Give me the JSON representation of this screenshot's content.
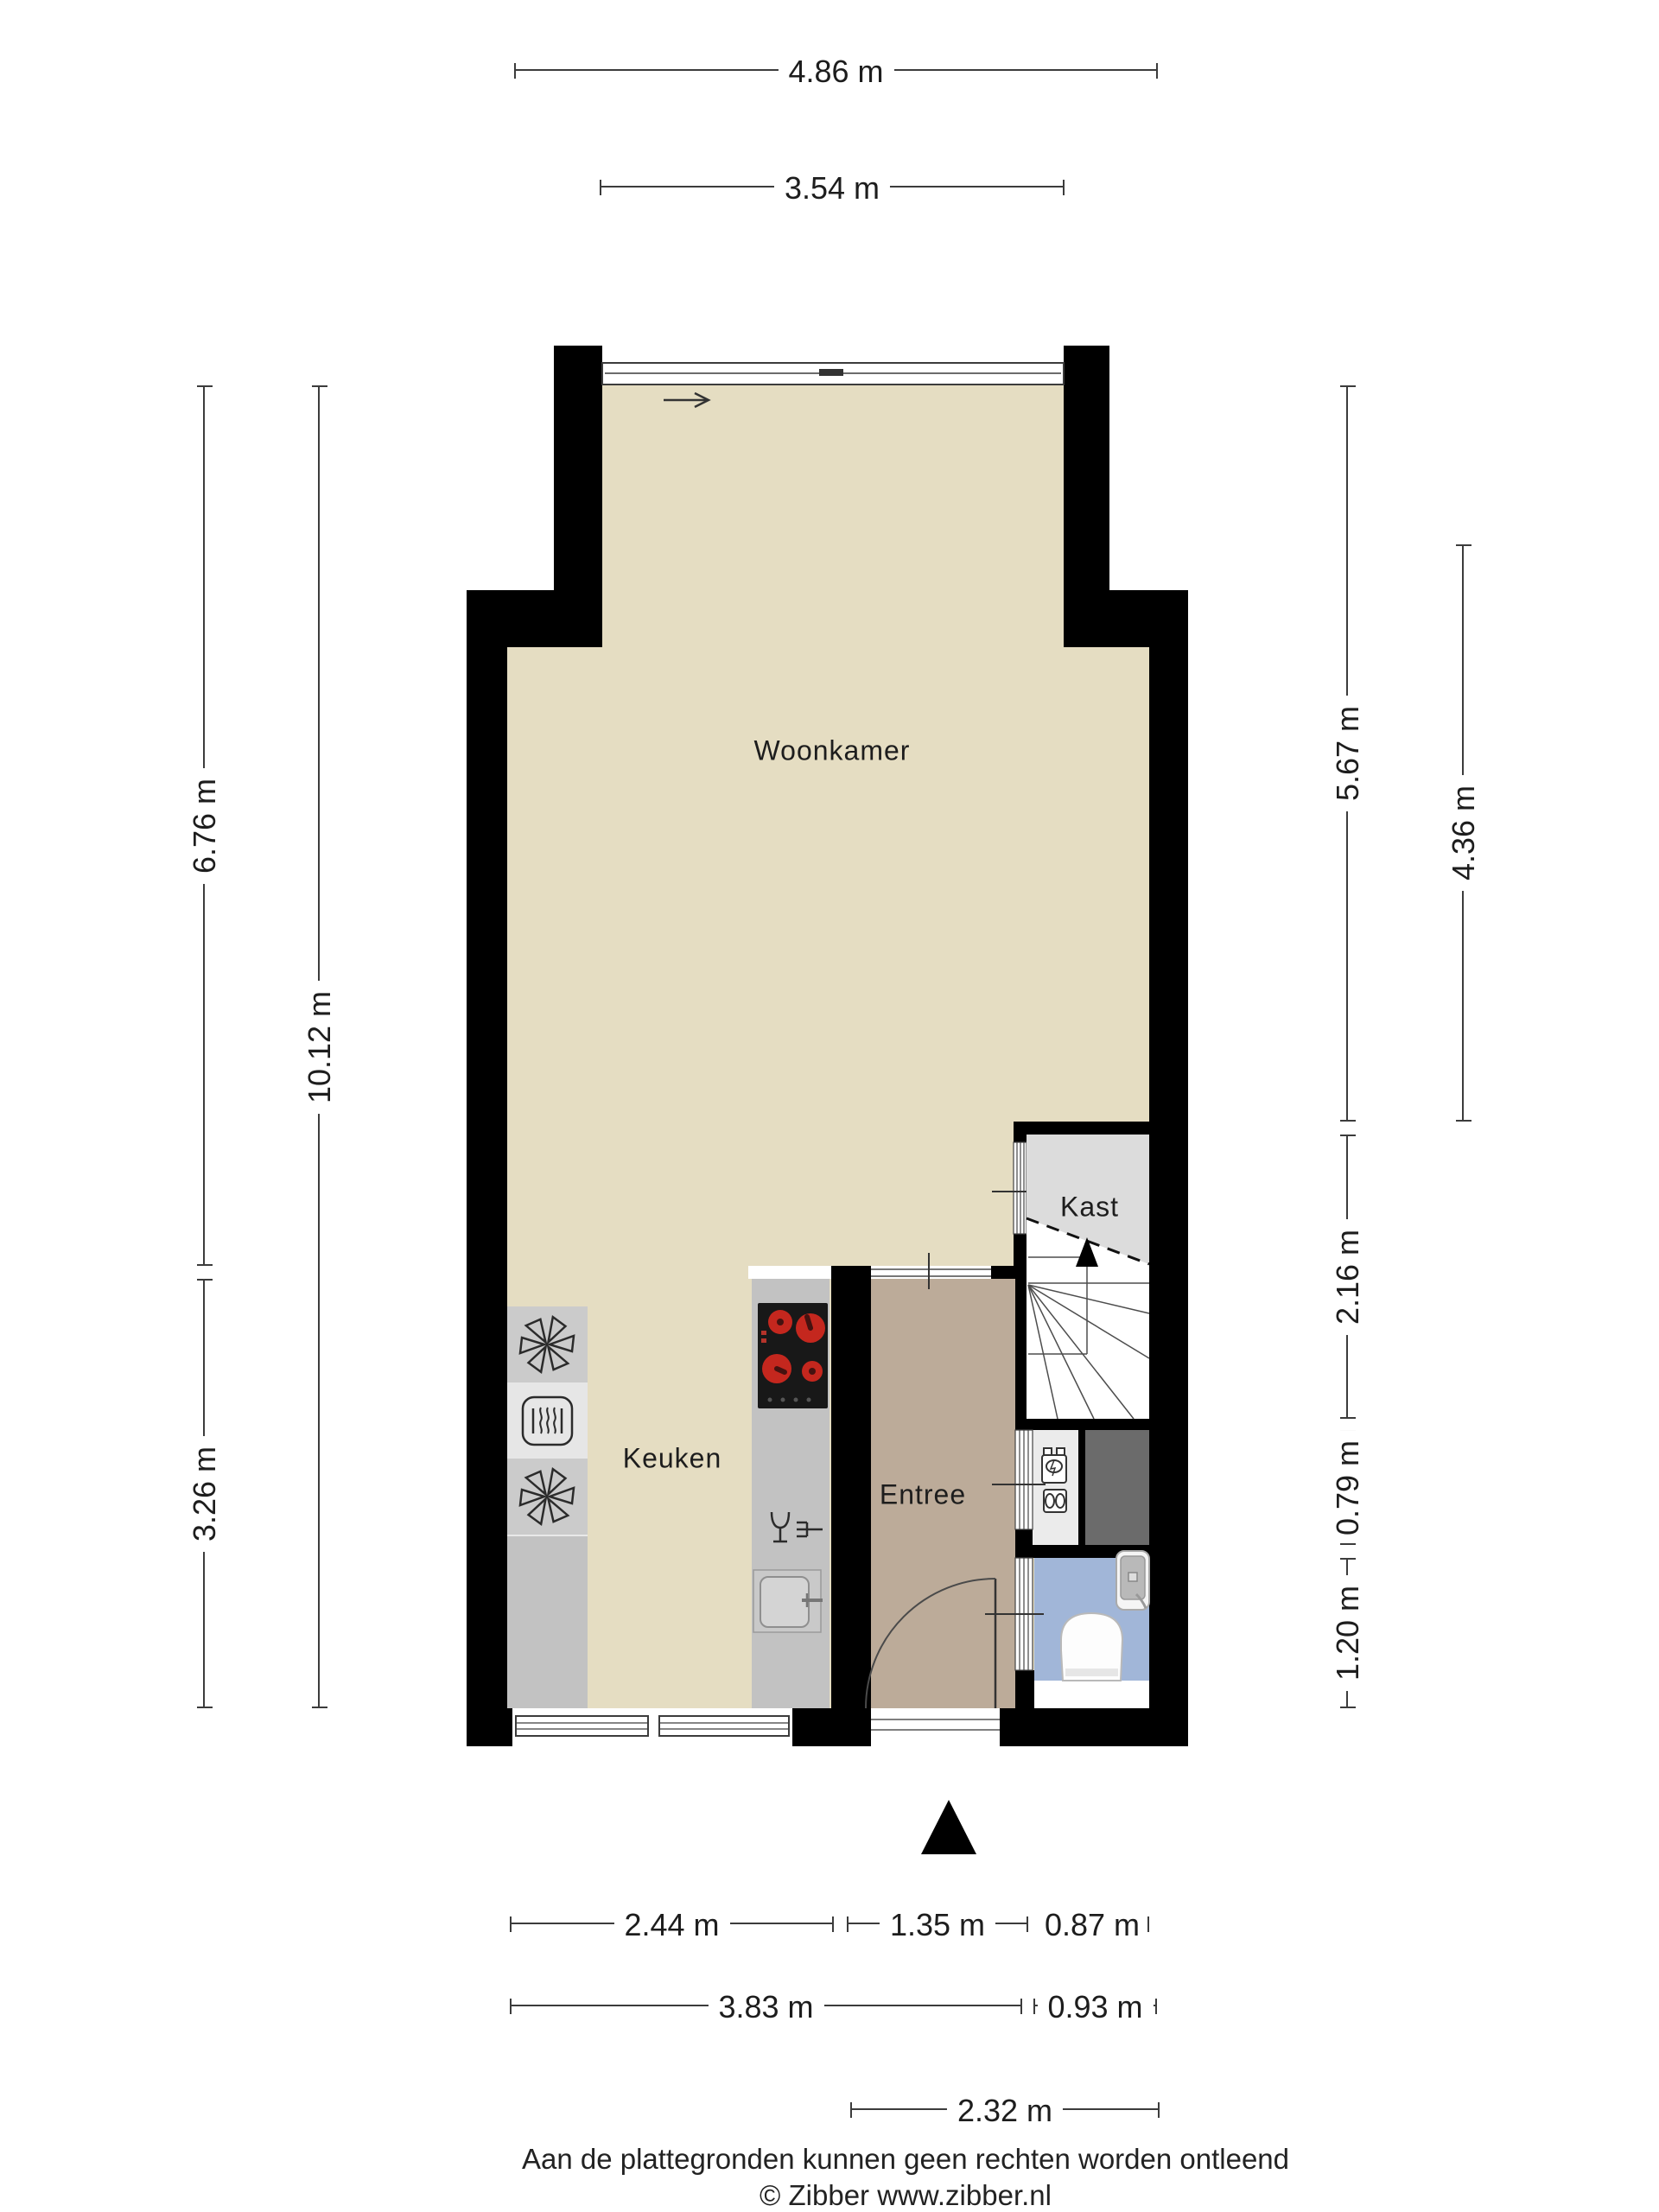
{
  "rooms": {
    "woonkamer": "Woonkamer",
    "keuken": "Keuken",
    "entree": "Entree",
    "kast": "Kast"
  },
  "dims": {
    "top": [
      "4.86 m",
      "3.54 m"
    ],
    "left": [
      "6.76 m",
      "10.12 m",
      "3.26 m"
    ],
    "right": [
      "5.67 m",
      "4.36 m",
      "2.16 m",
      "0.79 m",
      "1.20 m"
    ],
    "bottom": [
      "2.44 m",
      "1.35 m",
      "0.87 m",
      "3.83 m",
      "0.93 m",
      "2.32 m"
    ]
  },
  "footer": {
    "disclaimer": "Aan de plattegronden kunnen geen rechten worden ontleend",
    "copyright": "© Zibber www.zibber.nl"
  },
  "colors": {
    "wall": "#000000",
    "floor_living": "#e5ddc2",
    "floor_entree": "#bcab99",
    "floor_kast": "#dcdcdc",
    "floor_toilet": "#a1b6d8",
    "counter": "#c2c2c2",
    "appliance_block": "#cbcbcb",
    "oven_block": "#e6e6e6",
    "meter_cabinet": "#ebebeb",
    "meter_dark": "#6b6b6b",
    "burner_red": "#c4271e"
  },
  "icons": {
    "entrance": "entrance-arrow",
    "stairs": "stairs-up-arrow",
    "window_slide": "slide-direction-arrow",
    "appliances": [
      "washing-machine-icon",
      "oven-icon",
      "washing-machine-icon",
      "cooktop",
      "dishwasher-icon",
      "sink",
      "toilet",
      "washbasin",
      "utility-meters"
    ]
  }
}
